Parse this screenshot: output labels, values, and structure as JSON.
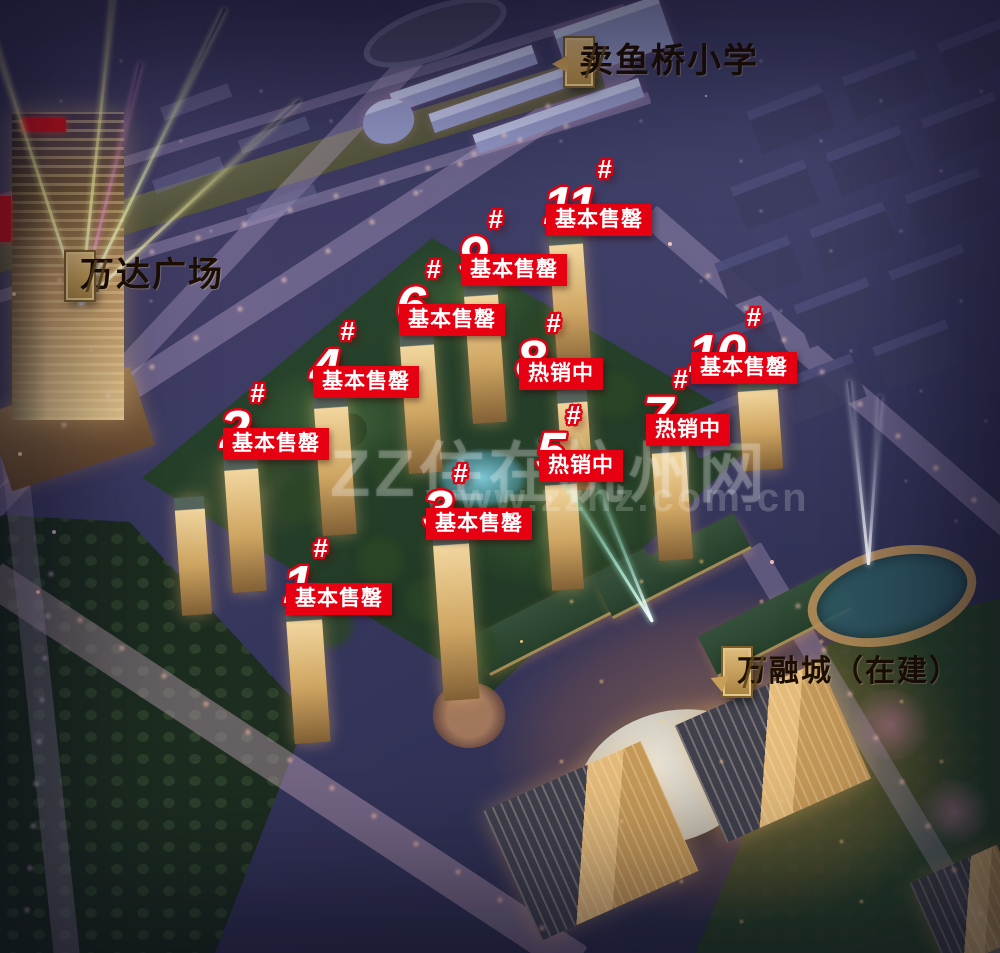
{
  "watermark": {
    "line1": "ZZ住在杭州网",
    "line2": "www.zzhz.com.cn"
  },
  "colors": {
    "marker_red": "#e60012",
    "marker_text": "#ffffff",
    "plaque_gold": "#c9a25c",
    "plaque_text": "#1d0f02"
  },
  "landmarks": [
    {
      "id": "maiyuqiao-school",
      "label": "卖鱼桥小学",
      "x": 565,
      "y": 38,
      "pointer": "left"
    },
    {
      "id": "wanda-plaza",
      "label": "万达广场",
      "x": 66,
      "y": 252,
      "pointer": "none"
    },
    {
      "id": "wanrong-city",
      "label": "万融城（在建）",
      "x": 723,
      "y": 648,
      "pointer": "down"
    }
  ],
  "buildings": [
    {
      "number": "1",
      "hash": "#",
      "status": "基本售罄",
      "x": 283,
      "y": 561
    },
    {
      "number": "2",
      "hash": "#",
      "status": "基本售罄",
      "x": 220,
      "y": 406
    },
    {
      "number": "3",
      "hash": "#",
      "status": "基本售罄",
      "x": 423,
      "y": 486
    },
    {
      "number": "4",
      "hash": "#",
      "status": "基本售罄",
      "x": 310,
      "y": 344
    },
    {
      "number": "5",
      "hash": "#",
      "status": "热销中",
      "x": 536,
      "y": 428
    },
    {
      "number": "6",
      "hash": "#",
      "status": "基本售罄",
      "x": 396,
      "y": 282
    },
    {
      "number": "7",
      "hash": "#",
      "status": "热销中",
      "x": 643,
      "y": 392
    },
    {
      "number": "8",
      "hash": "#",
      "status": "热销中",
      "x": 516,
      "y": 336
    },
    {
      "number": "9",
      "hash": "#",
      "status": "基本售罄",
      "x": 458,
      "y": 232
    },
    {
      "number": "10",
      "hash": "#",
      "status": "基本售罄",
      "x": 688,
      "y": 330
    },
    {
      "number": "11",
      "hash": "#",
      "status": "基本售罄",
      "x": 543,
      "y": 182
    }
  ]
}
